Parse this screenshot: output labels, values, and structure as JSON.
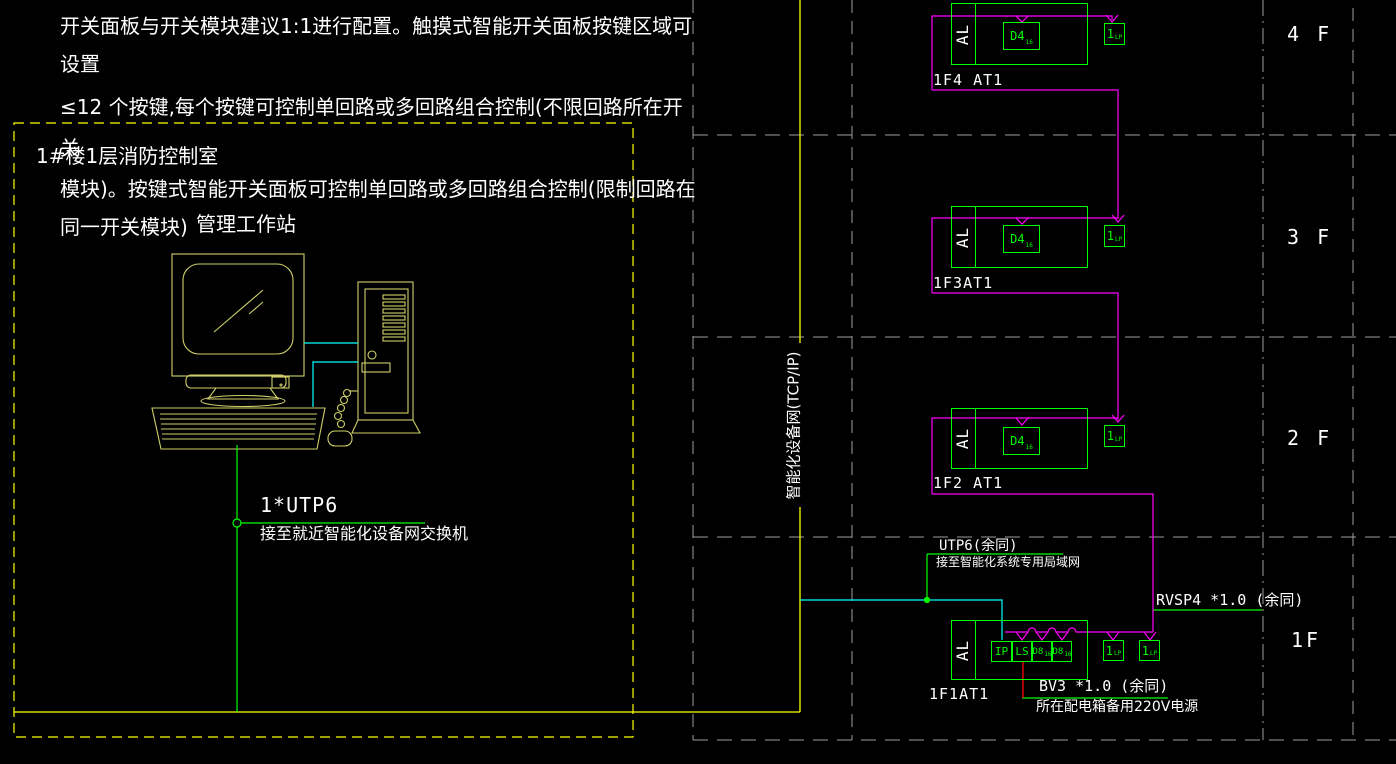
{
  "colors": {
    "background": "#000000",
    "line_green": "#00ff00",
    "line_magenta": "#ff00ff",
    "line_cyan": "#00ffff",
    "line_yellow": "#ffff00",
    "line_red": "#ff0000",
    "line_gray": "#9e9e9e",
    "computer_outline": "#cfcf6b",
    "text_white": "#ffffff"
  },
  "notes": {
    "line1": "开关面板与开关模块建议1:1进行配置。触摸式智能开关面板按键区域可",
    "line2": "设置",
    "line3": "≤12 个按键,每个按键可控制单回路或多回路组合控制(不限回路所在开",
    "line4": "关",
    "line5": "模块)。按键式智能开关面板可控制单回路或多回路组合控制(限制回路在",
    "line6": "同一开关模块)"
  },
  "control_room": {
    "label": "1#楼1层消防控制室",
    "workstation": "管理工作站",
    "link_label": "1*UTP6",
    "link_note": "接至就近智能化设备网交换机"
  },
  "riser": {
    "label": "智能化设备网(TCP/IP)"
  },
  "floors": [
    {
      "floor": "4 F",
      "panel": "1F4 AT1",
      "al": "AL",
      "dimmer": "D4",
      "dimmer_sub": "16",
      "lp": "1",
      "lp_sub": "LP"
    },
    {
      "floor": "3 F",
      "panel": "1F3AT1",
      "al": "AL",
      "dimmer": "D4",
      "dimmer_sub": "16",
      "lp": "1",
      "lp_sub": "LP"
    },
    {
      "floor": "2 F",
      "panel": "1F2 AT1",
      "al": "AL",
      "dimmer": "D4",
      "dimmer_sub": "16",
      "lp": "1",
      "lp_sub": "LP"
    }
  ],
  "floor1": {
    "floor": "1F",
    "panel": "1F1AT1",
    "al": "AL",
    "modules": [
      {
        "label": "IP",
        "sub": ""
      },
      {
        "label": "LS",
        "sub": ""
      },
      {
        "label": "D8",
        "sub": "16"
      },
      {
        "label": "D8",
        "sub": "16"
      }
    ],
    "lps": [
      {
        "label": "1",
        "sub": "LP"
      },
      {
        "label": "1",
        "sub": "LP"
      }
    ],
    "utp_label": "UTP6(余同)",
    "utp_note": "接至智能化系统专用局域网",
    "rvsp_label": "RVSP4 *1.0 (余同)",
    "bv_label": "BV3 *1.0 (余同)",
    "bv_note": "所在配电箱备用220V电源"
  }
}
